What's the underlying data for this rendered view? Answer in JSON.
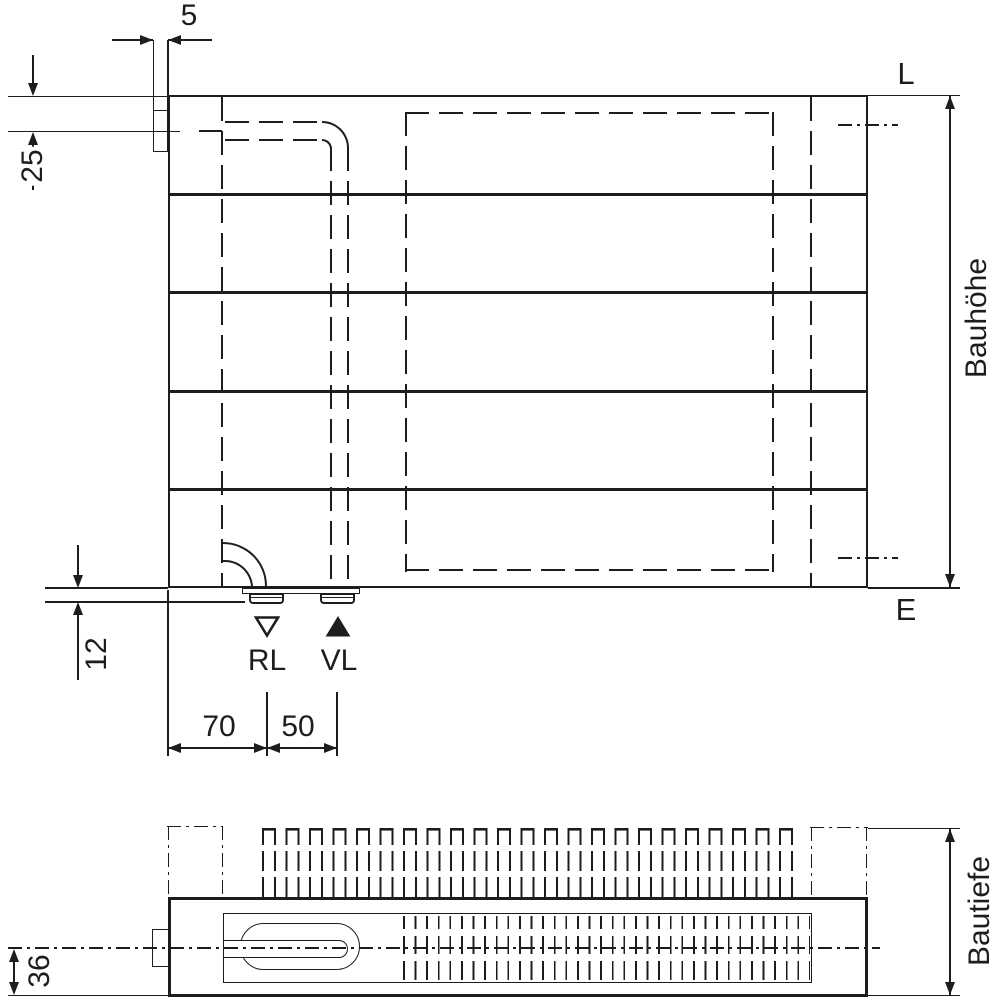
{
  "style": {
    "ink": "#1d1d1d",
    "background": "#ffffff"
  },
  "front_view": {
    "labels": {
      "outlet_top": "L",
      "outlet_bottom": "E",
      "return_connection": "RL",
      "supply_connection": "VL",
      "height": "Bauhöhe"
    },
    "dimensions": {
      "tab_width": "5",
      "top_pipe_offset": "25",
      "bottom_stub_depth": "12",
      "edge_to_return": "70",
      "return_to_supply": "50"
    }
  },
  "bottom_view": {
    "labels": {
      "depth": "Bautiefe"
    },
    "dimensions": {
      "center_to_bottom": "36"
    }
  },
  "icons": {
    "supply_marker": "triangle-up-filled-icon",
    "return_marker": "triangle-down-open-icon"
  }
}
